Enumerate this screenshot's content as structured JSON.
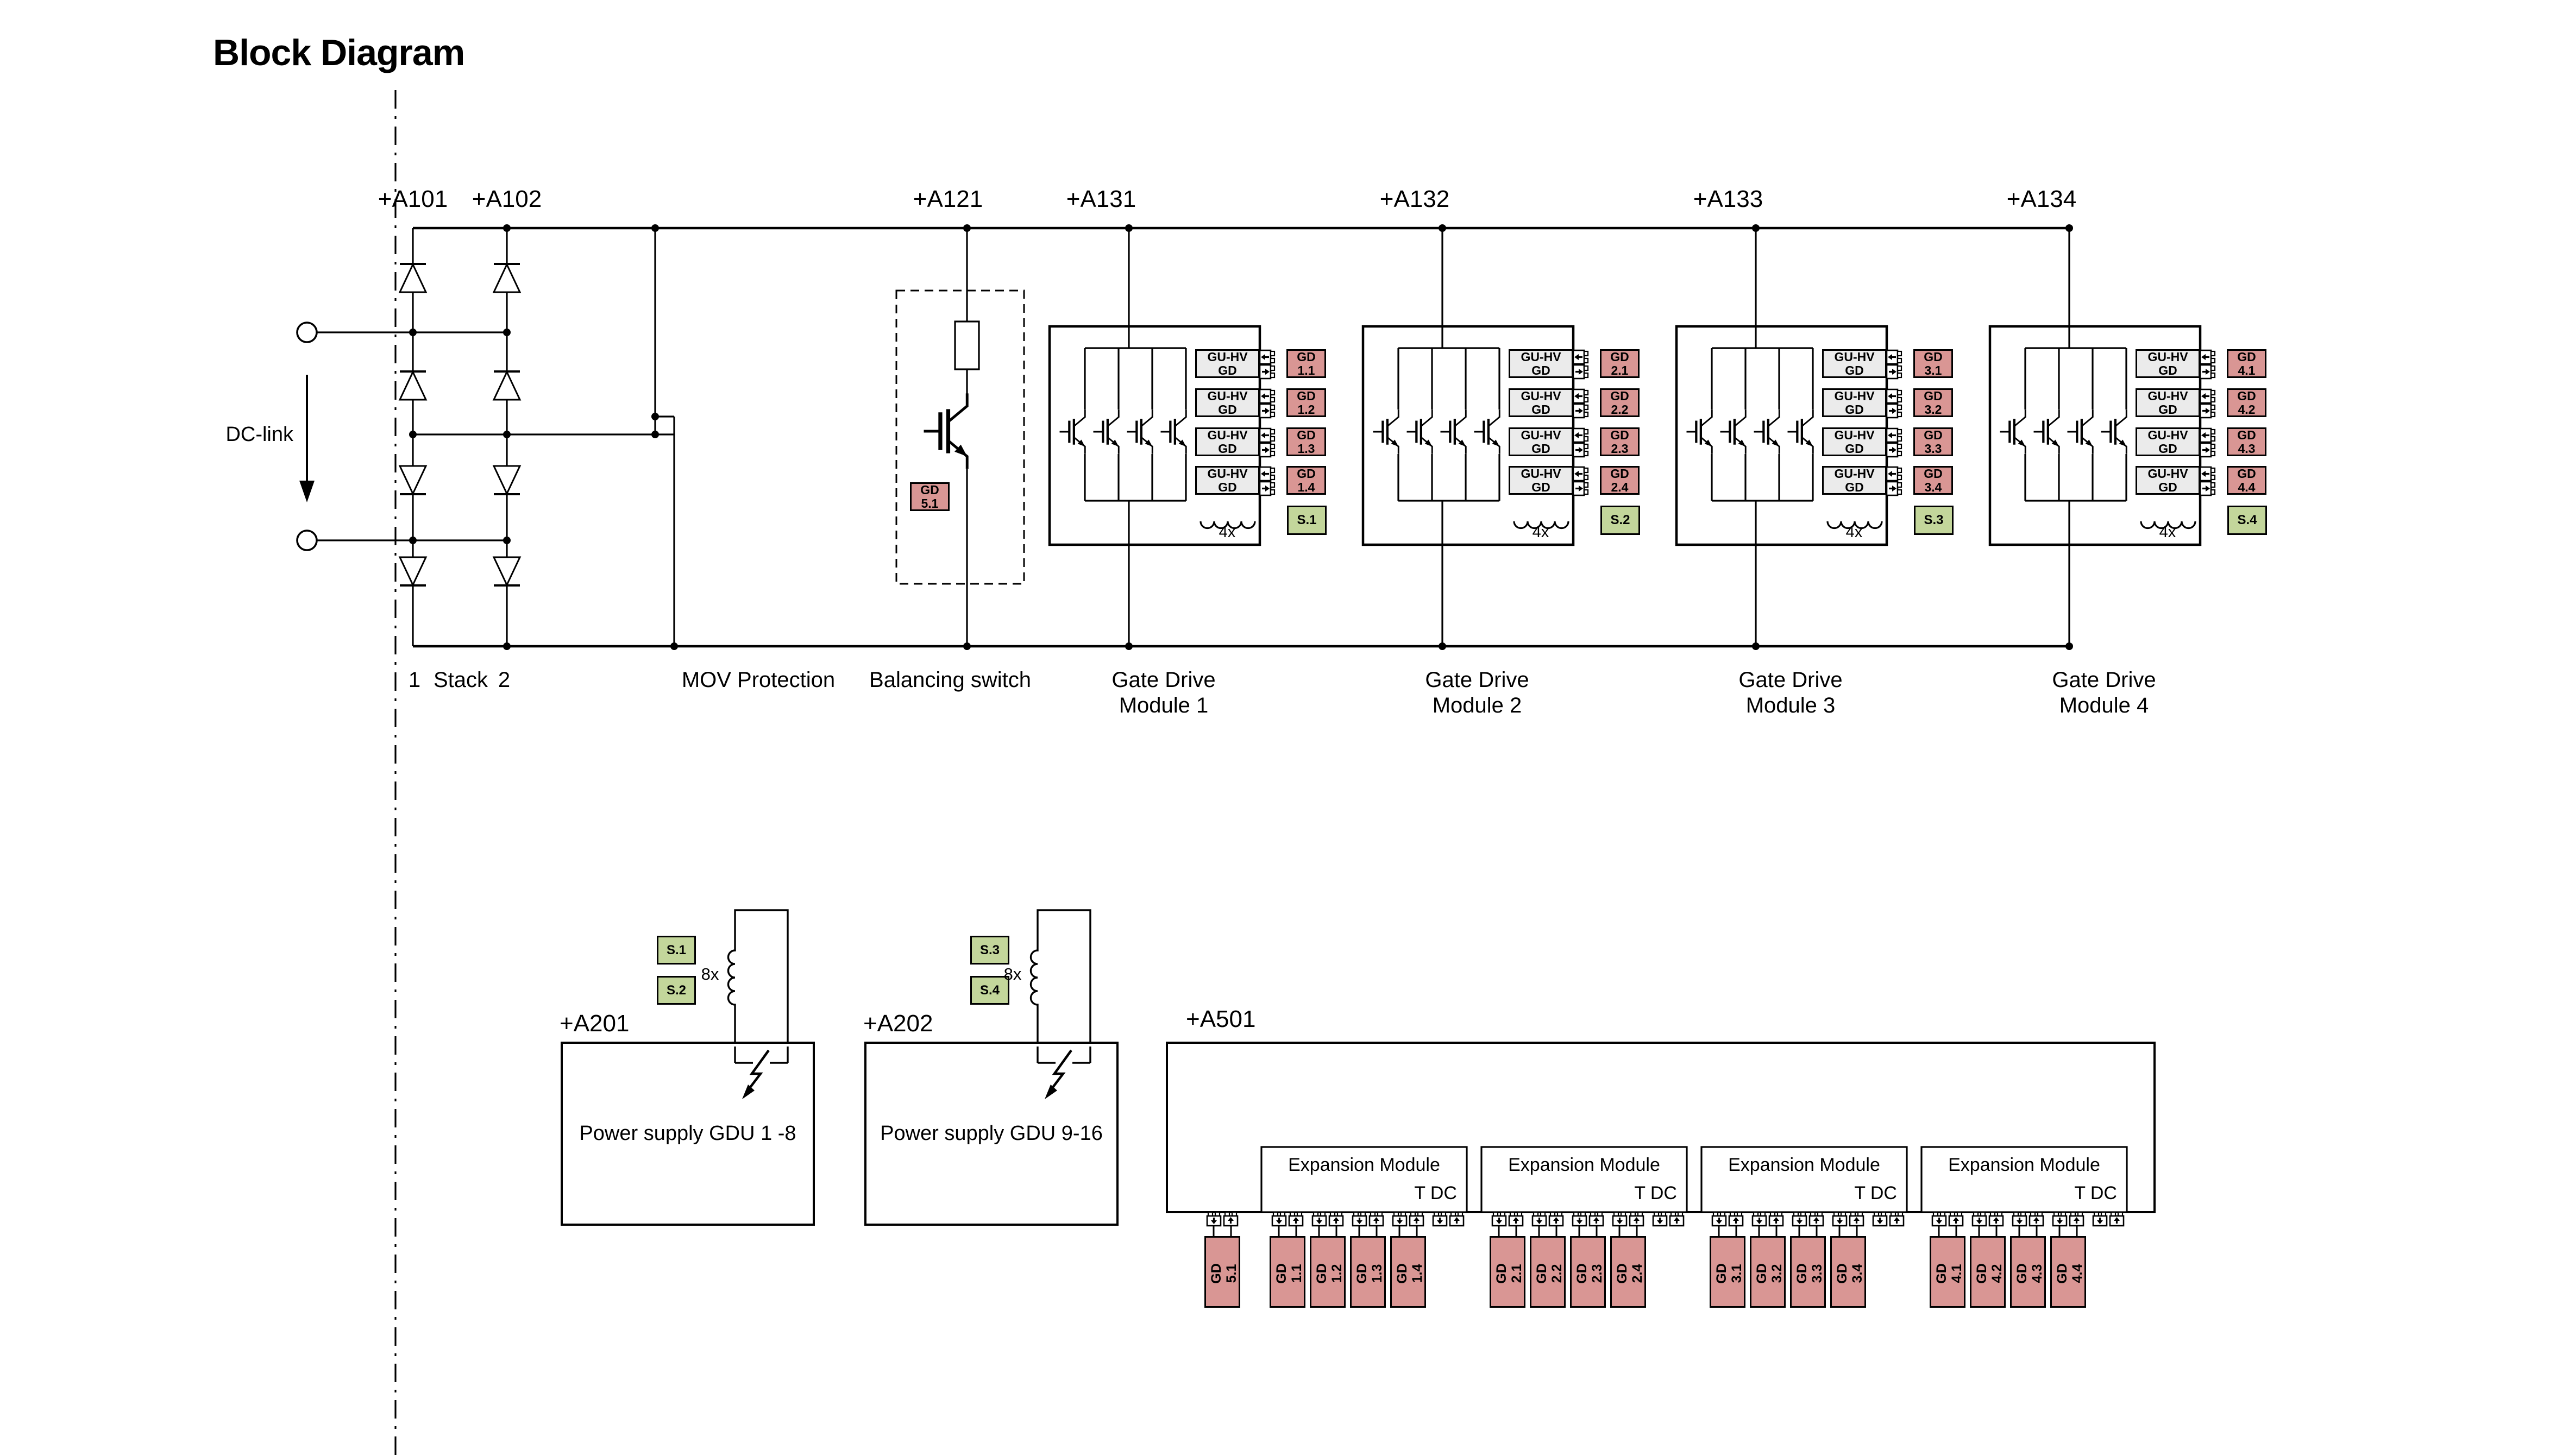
{
  "title": "Block Diagram",
  "dc_link_label": "DC-link",
  "colors": {
    "pink": "#d99694",
    "green": "#c3d69b",
    "gray": "#ebebeb",
    "line": "#000000"
  },
  "stack": {
    "ref_left": "+A101",
    "ref_right": "+A102",
    "label_left": "1",
    "label_center": "Stack",
    "label_right": "2"
  },
  "mov_label": "MOV Protection",
  "balancing": {
    "ref": "+A121",
    "label": "Balancing switch",
    "gd_number": "5.1"
  },
  "shared": {
    "gu_line1": "GU-HV",
    "gu_line2": "GD",
    "gd_prefix": "GD",
    "inductor_count": "4x",
    "coil_count": "8x",
    "expansion_title": "Expansion Module",
    "tdc_label": "T DC"
  },
  "gate_drive_modules": [
    {
      "ref": "+A131",
      "caption_line1": "Gate Drive",
      "caption_line2": "Module 1",
      "gd_numbers": [
        "1.1",
        "1.2",
        "1.3",
        "1.4"
      ],
      "s_label": "S.1"
    },
    {
      "ref": "+A132",
      "caption_line1": "Gate Drive",
      "caption_line2": "Module 2",
      "gd_numbers": [
        "2.1",
        "2.2",
        "2.3",
        "2.4"
      ],
      "s_label": "S.2"
    },
    {
      "ref": "+A133",
      "caption_line1": "Gate Drive",
      "caption_line2": "Module 3",
      "gd_numbers": [
        "3.1",
        "3.2",
        "3.3",
        "3.4"
      ],
      "s_label": "S.3"
    },
    {
      "ref": "+A134",
      "caption_line1": "Gate Drive",
      "caption_line2": "Module 4",
      "gd_numbers": [
        "4.1",
        "4.2",
        "4.3",
        "4.4"
      ],
      "s_label": "S.4"
    }
  ],
  "power_supplies": [
    {
      "ref": "+A201",
      "label": "Power supply GDU 1 -8",
      "s_labels": [
        "S.1",
        "S.2"
      ]
    },
    {
      "ref": "+A202",
      "label": "Power supply GDU 9-16",
      "s_labels": [
        "S.3",
        "S.4"
      ]
    }
  ],
  "a501": {
    "ref": "+A501",
    "gd_number": "5.1",
    "expansion_modules": [
      {
        "gd_numbers": [
          "1.1",
          "1.2",
          "1.3",
          "1.4"
        ]
      },
      {
        "gd_numbers": [
          "2.1",
          "2.2",
          "2.3",
          "2.4"
        ]
      },
      {
        "gd_numbers": [
          "3.1",
          "3.2",
          "3.3",
          "3.4"
        ]
      },
      {
        "gd_numbers": [
          "4.1",
          "4.2",
          "4.3",
          "4.4"
        ]
      }
    ]
  }
}
